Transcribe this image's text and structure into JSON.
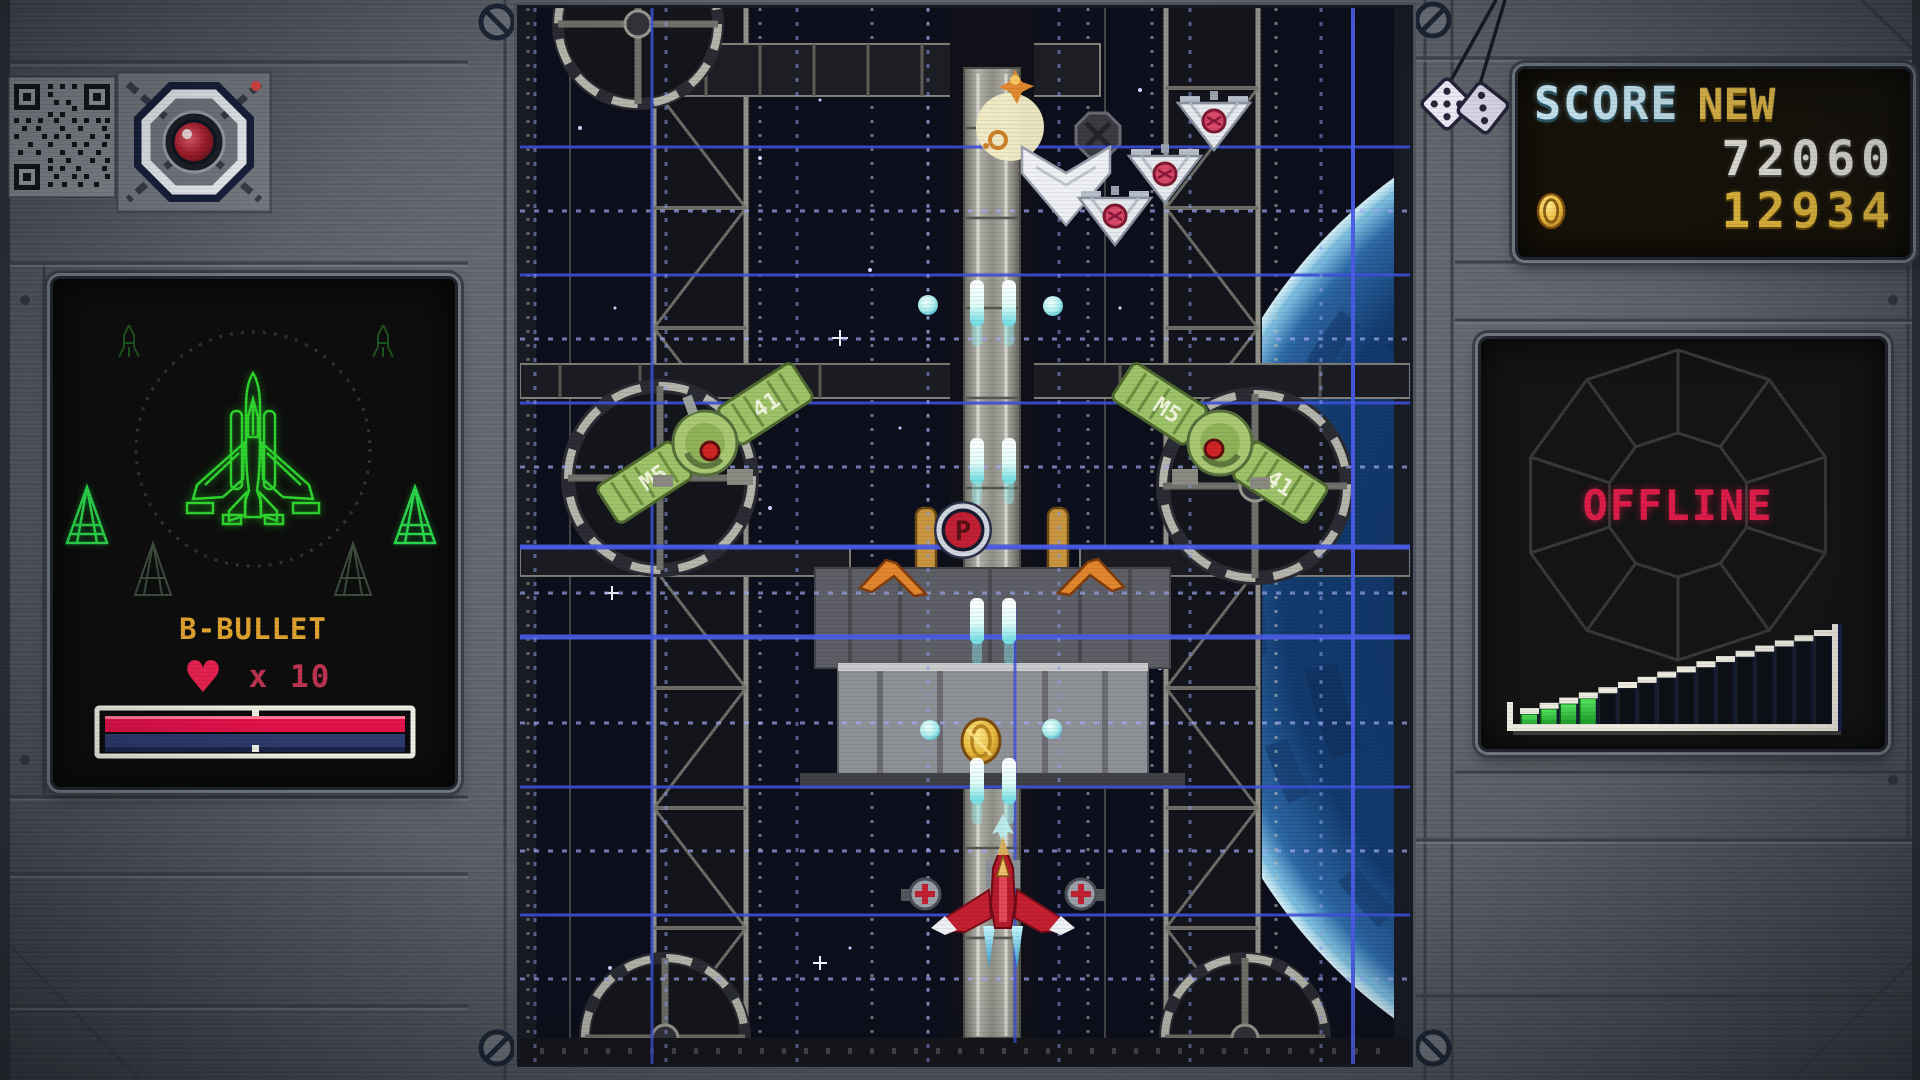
{
  "hud": {
    "score_panel": {
      "title": "SCORE",
      "badge": "NEW",
      "score": "72060",
      "coins": "12934"
    },
    "status_panel": {
      "status": "OFFLINE",
      "meter": {
        "segments": 16,
        "filled": 4
      }
    },
    "ship_panel": {
      "weapon": "B-BULLET",
      "lives": "x 10",
      "heart_symbol": "♥"
    }
  },
  "playfield": {
    "powerup_letter": "P",
    "satellites": {
      "left": {
        "panels": [
          "41",
          "M5"
        ]
      },
      "right": {
        "panels": [
          "M5",
          "41"
        ]
      }
    }
  },
  "icons": {
    "camera": "camera-lens-icon",
    "qr": "qr-code-icon",
    "dice": "hanging-dice-icon",
    "coin": "coin-icon",
    "heart": "heart-icon"
  },
  "colors": {
    "grid_blue": "#3b4fd8",
    "alert_red": "#dc1c48",
    "hud_gold": "#e2b83e",
    "wireframe_green": "#2ed32e",
    "meter_green": "#3ede4a"
  }
}
